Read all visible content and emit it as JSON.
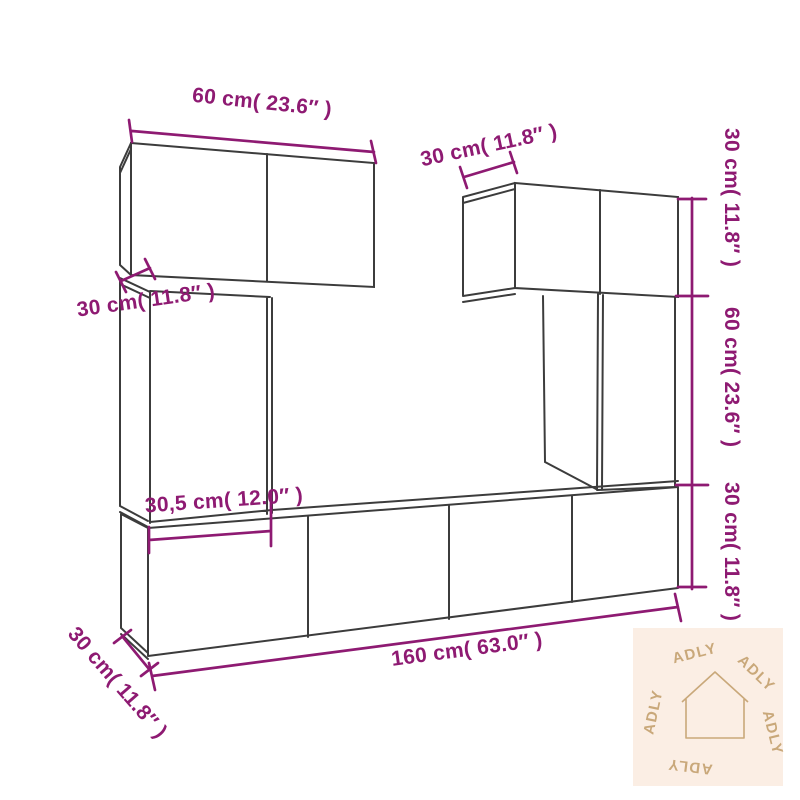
{
  "diagram": {
    "dimensions": {
      "top_width": "60 cm( 23.6″ )",
      "upper_right_depth": "30 cm( 11.8″ )",
      "left_shelf_depth": "30 cm( 11.8″ )",
      "lower_left_width": "30,5 cm( 12.0″ )",
      "total_width": "160 cm( 63.0″ )",
      "stand_depth": "30 cm( 11.8″ )",
      "right_top_height": "30 cm( 11.8″ )",
      "right_middle_height": "60 cm( 23.6″ )",
      "right_bottom_height": "30 cm( 11.8″ )"
    },
    "colors": {
      "dimension": "#8e1a72",
      "outline": "#3c3c3c",
      "background": "#ffffff",
      "watermark_bg": "#fbeee4",
      "watermark_fg": "#c9a87a"
    },
    "watermark": {
      "brand": "ADLY",
      "icon": "house-icon"
    }
  }
}
